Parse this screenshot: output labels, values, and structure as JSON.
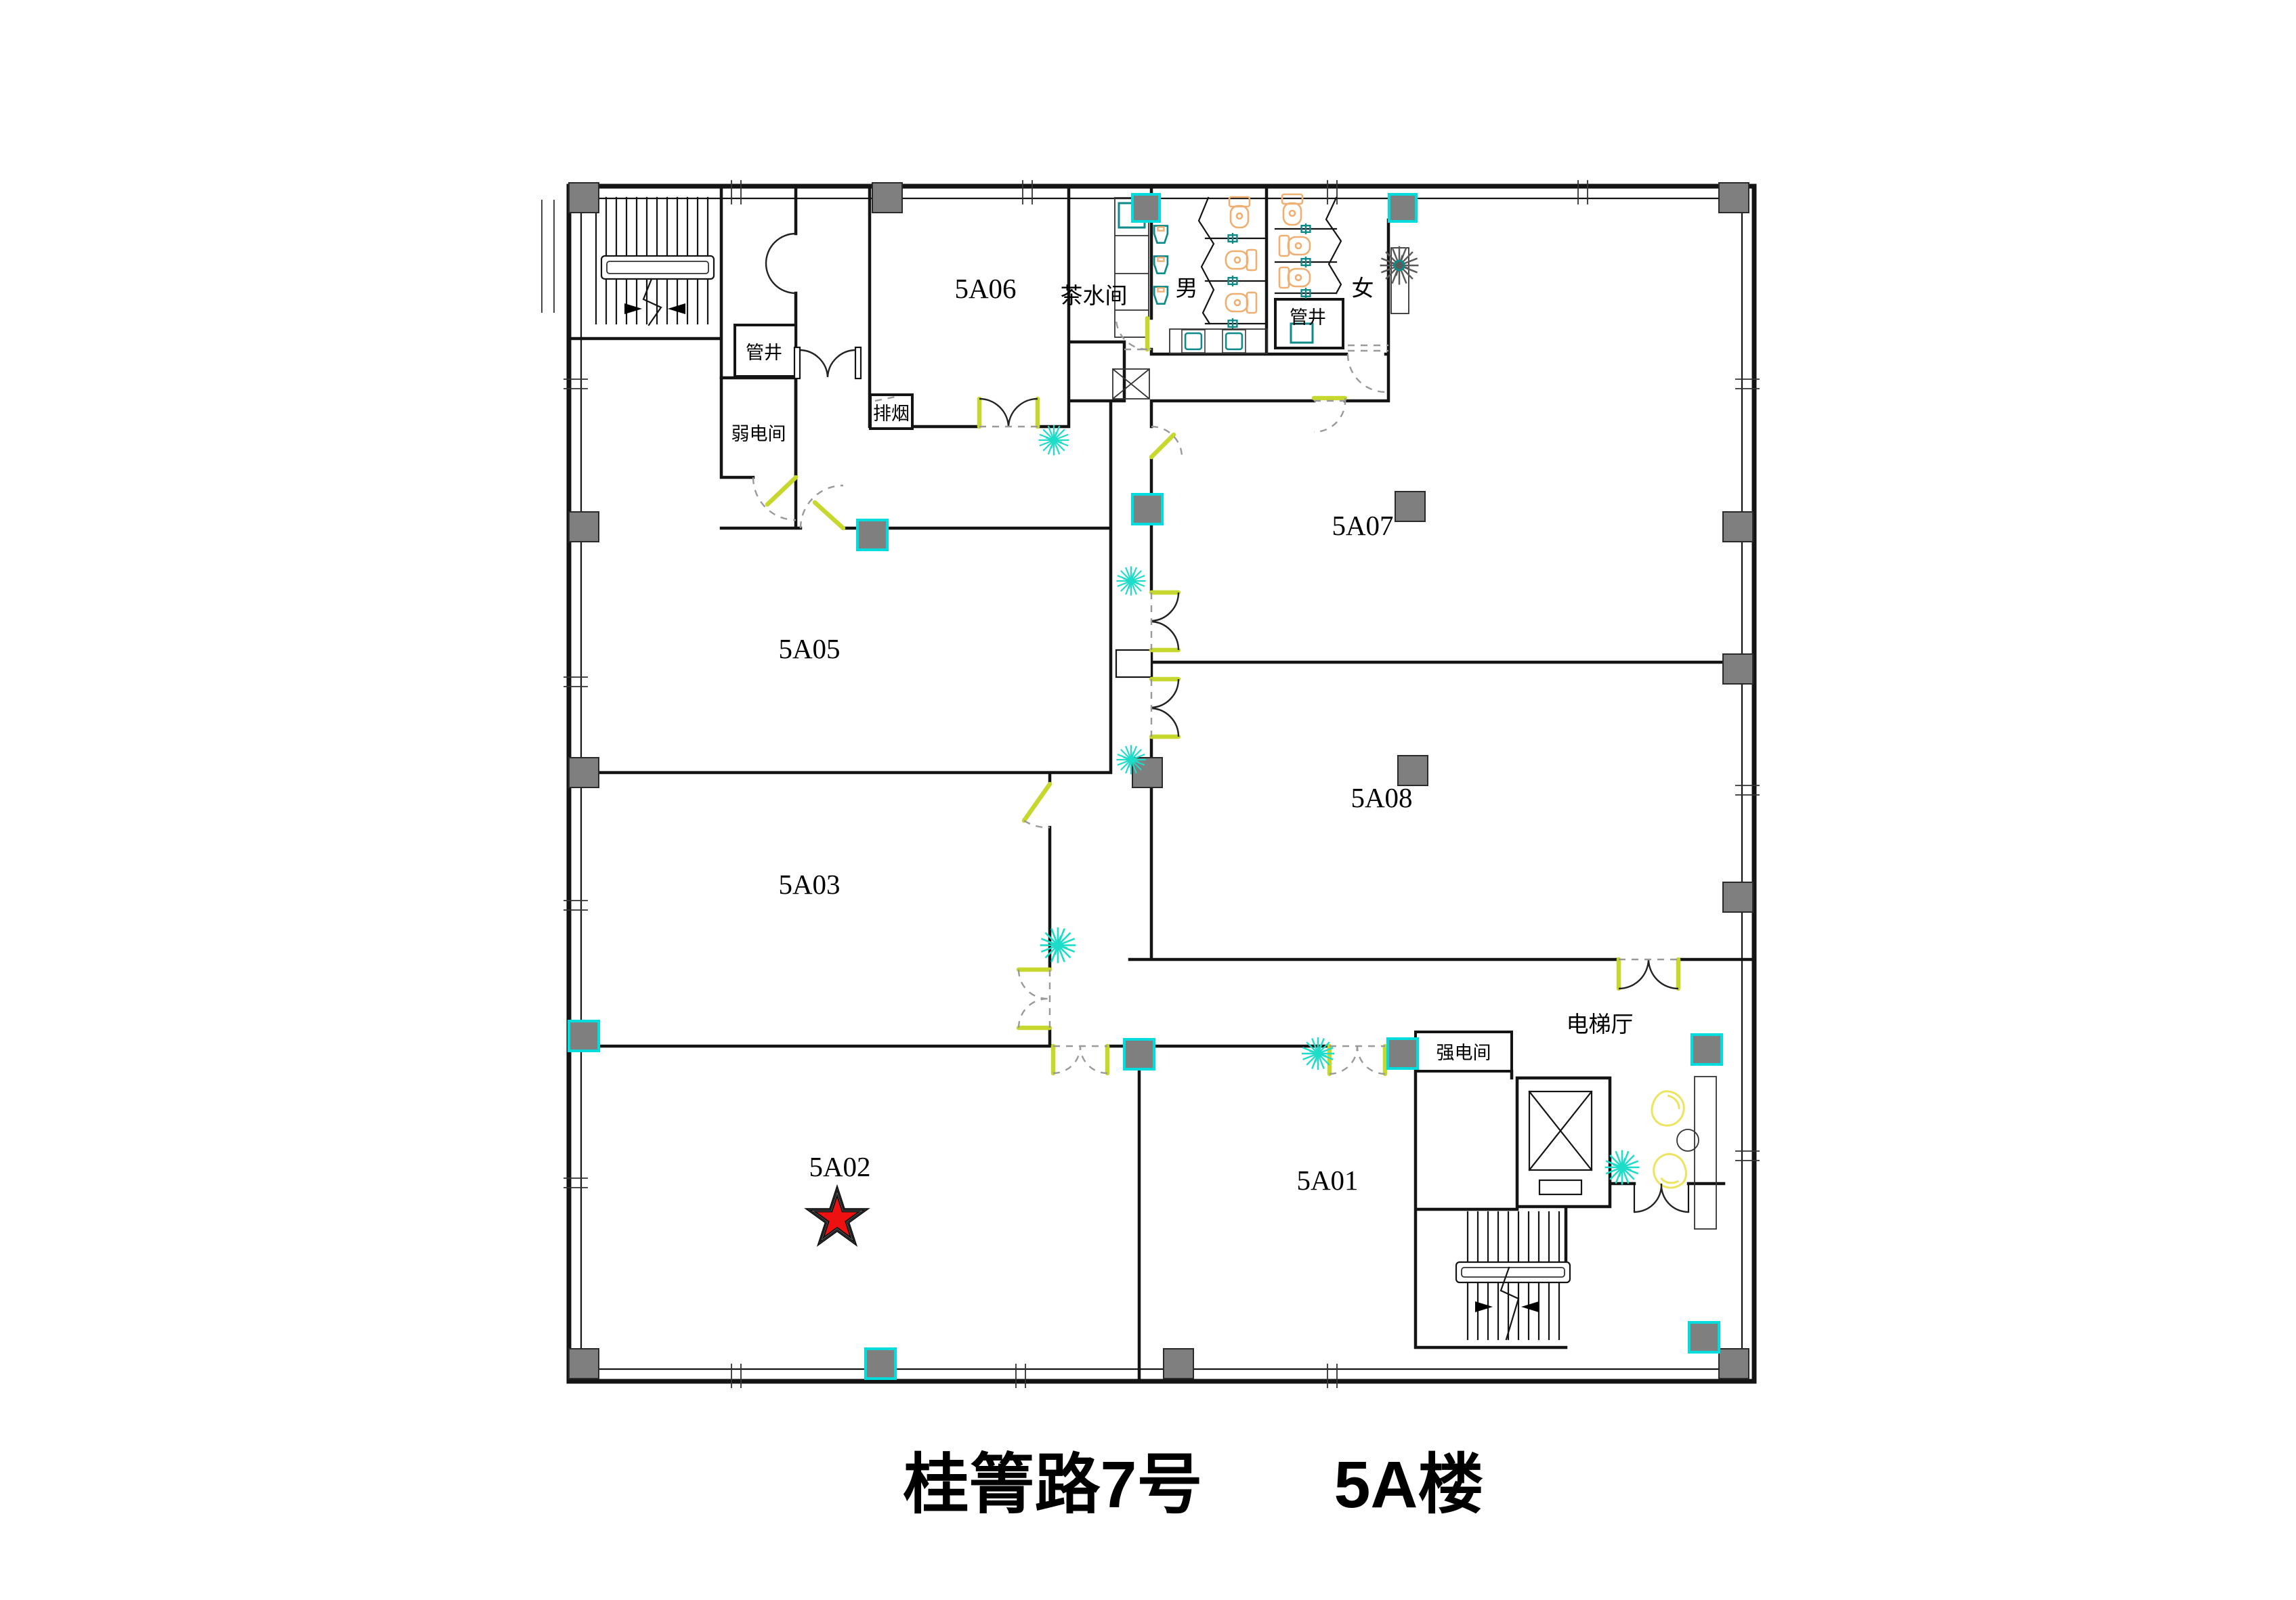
{
  "title": "桂箐路7号　　5A楼",
  "labels": {
    "r5a01": "5A01",
    "r5a02": "5A02",
    "r5a03": "5A03",
    "r5a05": "5A05",
    "r5a06": "5A06",
    "r5a07": "5A07",
    "r5a08": "5A08",
    "tea_room": "茶水间",
    "male_wc": "男",
    "female_wc": "女",
    "pipe_shaft_1": "管井",
    "pipe_shaft_2": "管井",
    "weak_current": "弱电间",
    "smoke_exhaust": "排烟",
    "strong_current": "强电间",
    "elevator_hall": "电梯厅"
  },
  "marker": {
    "type": "star",
    "room": "5A02"
  },
  "colors": {
    "wall": "#141414",
    "column": "#7f7f7f",
    "column_accent": "#00dcdc",
    "door_leaf": "#c6d82e",
    "swing": "#999999",
    "plant": "#1ddcc8",
    "flower": "#ece45f",
    "fixture": "#efaf72",
    "sink": "#0d8a8a",
    "star": "#ee1111",
    "ink": "#000000"
  }
}
